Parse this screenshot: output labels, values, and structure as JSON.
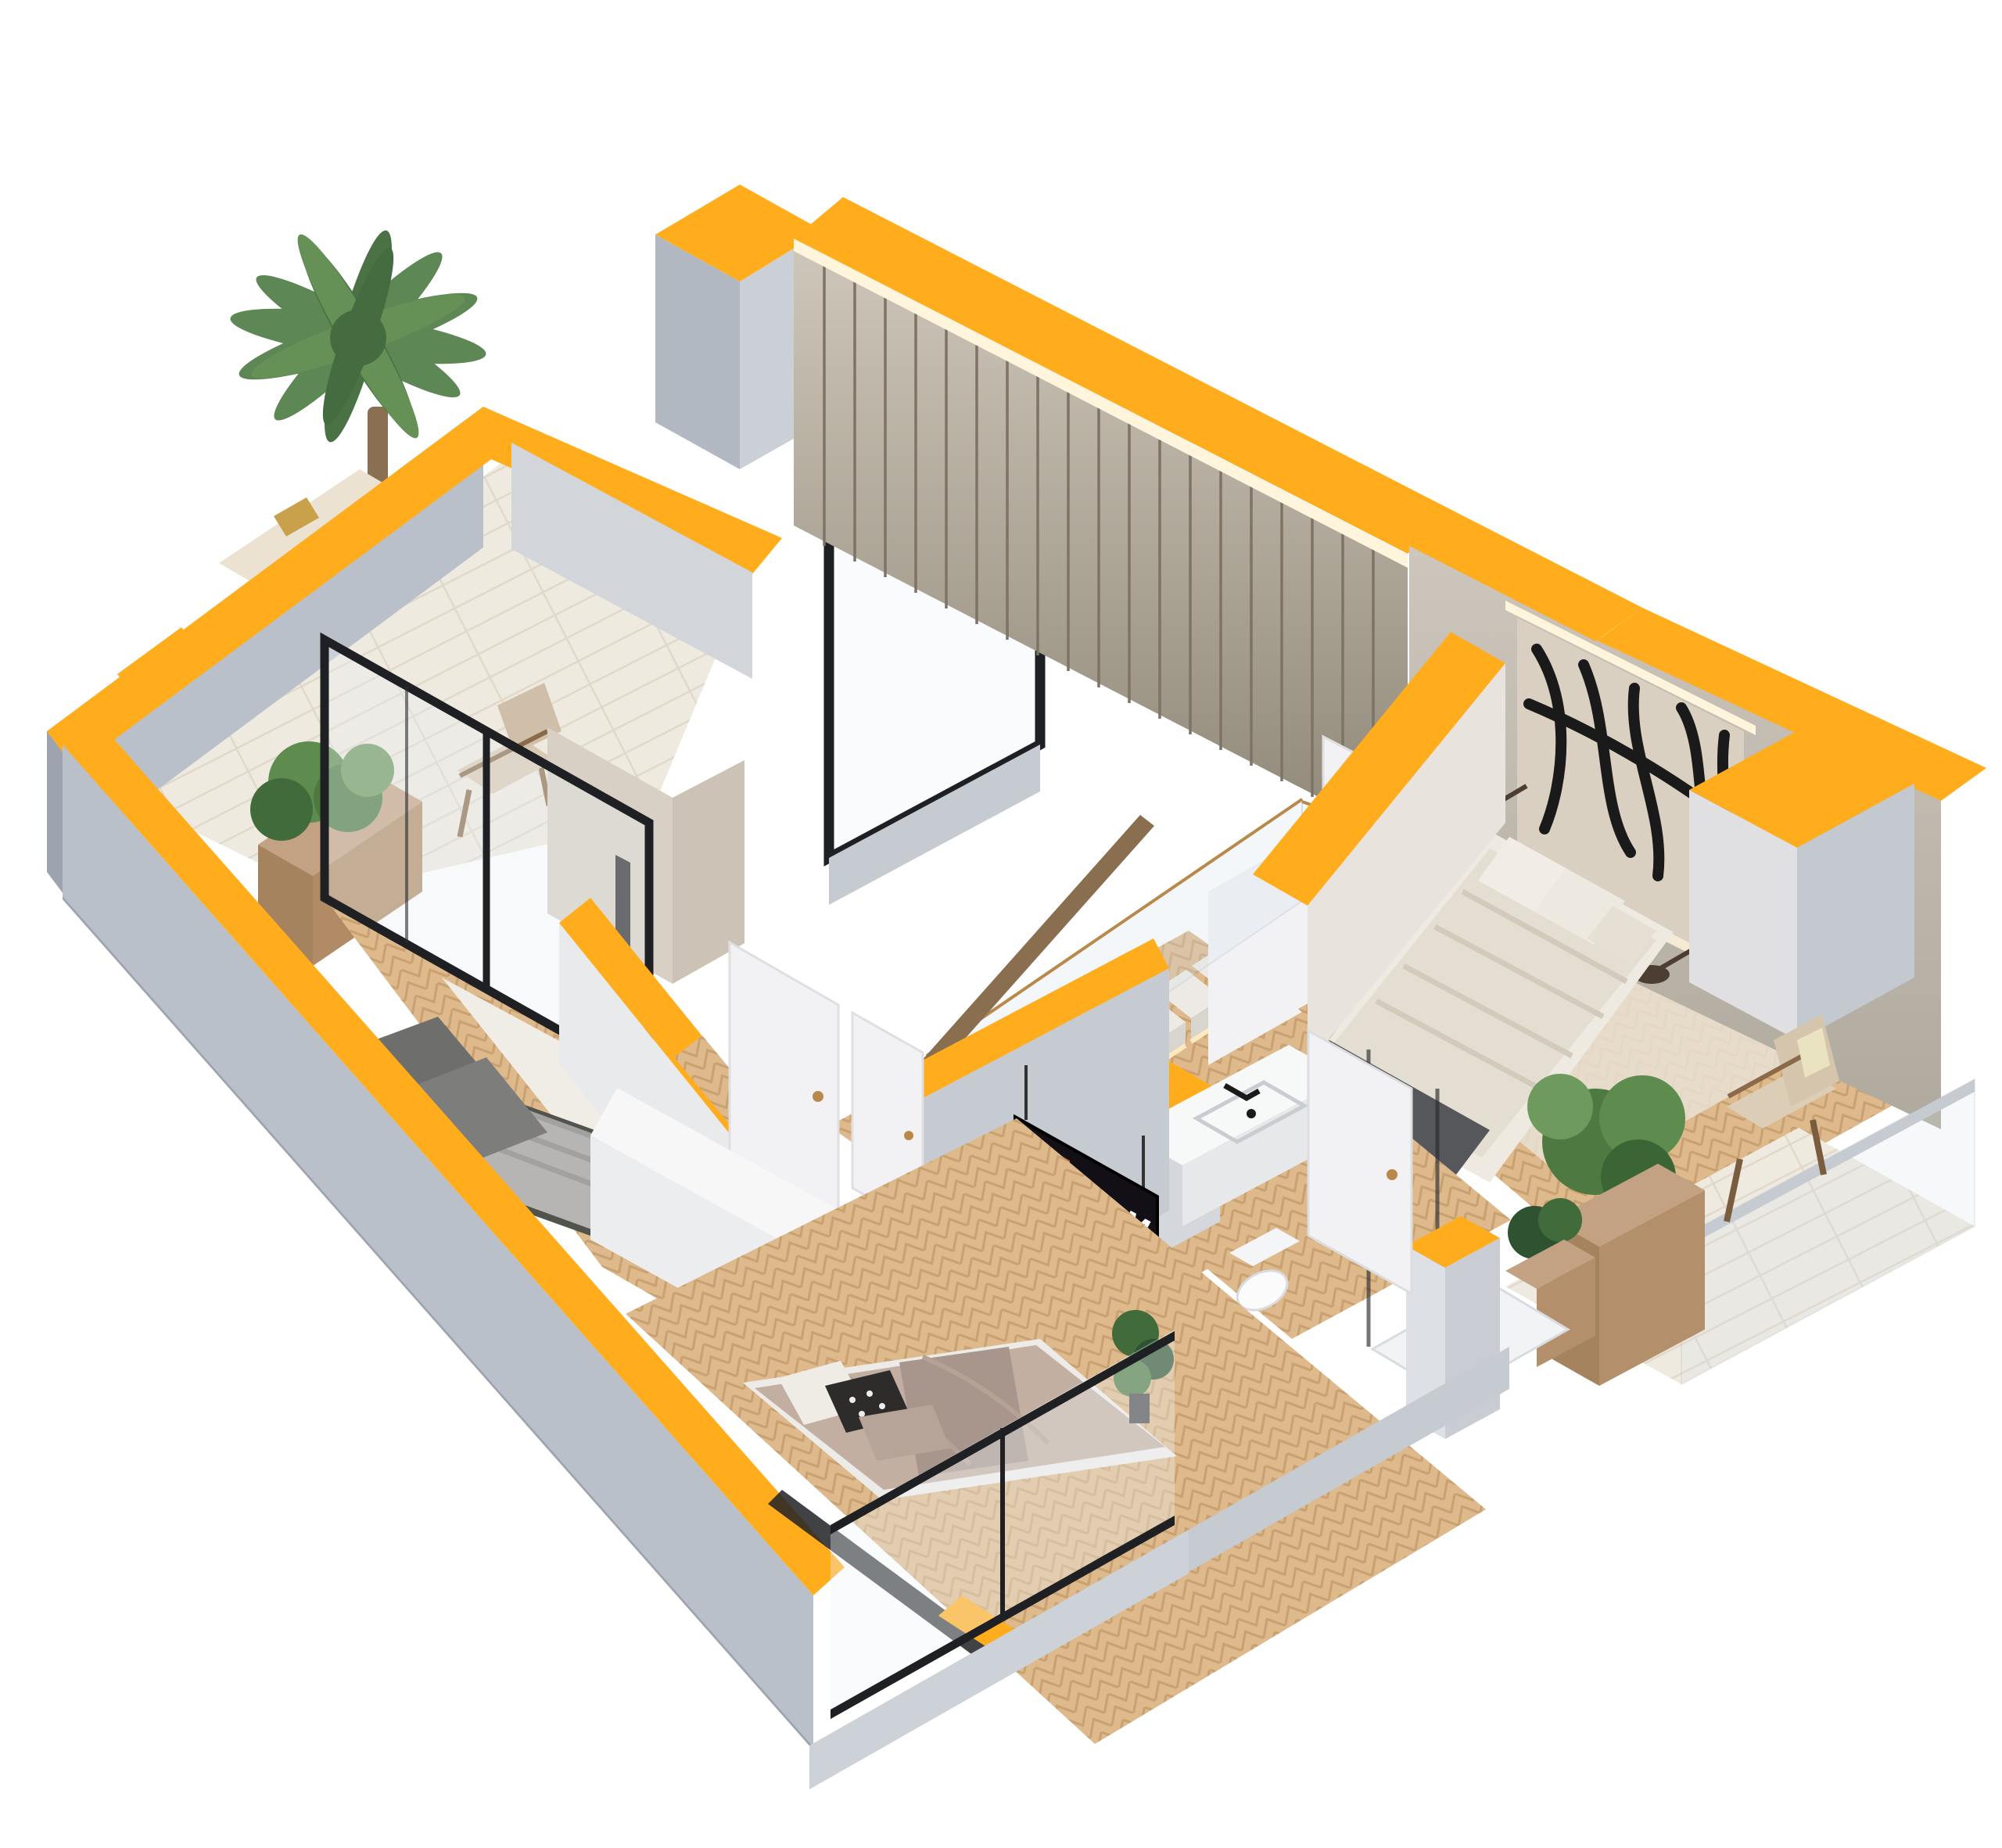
{
  "scene": {
    "kind": "isometric-cutaway-floorplan-render",
    "background": "#ffffff",
    "tv": {
      "app_label": "Music"
    },
    "colors": {
      "accent": "#FFAD1C",
      "wall_gray": "#BAC0C9",
      "wall_gray_dark": "#9DA4AF",
      "white_wall": "#F2F2F4",
      "interior_beige": "#D8D0C4",
      "concrete_headboard": "#C2BCB2",
      "slat_wall_dark": "#968D7E",
      "wood_floor": "#DDB98C",
      "wood_floor_line": "#C9A171",
      "tile_floor": "#EFEAE0",
      "rug_white": "#F0EDE6",
      "wood_furniture": "#C3A183",
      "glass_frame_black": "#1E2023",
      "brass": "#B9894C",
      "led_glow": "#FFF4DC",
      "duvet_gray": "#B7B5B3",
      "bed_frame_dark": "#50544C",
      "duvet_taupe": "#C2AFA2",
      "duvet_cream": "#E4DDD1",
      "throw_dark": "#56575B",
      "plant_green": "#4E7A42",
      "palm_green": "#55814B",
      "art_panel": "#D9D0C1",
      "tv_black": "#121016",
      "tv_tile_orange": "#C4692A",
      "tv_tile_red": "#DF2B25",
      "tv_tile_purple": "#7E3F93"
    }
  }
}
